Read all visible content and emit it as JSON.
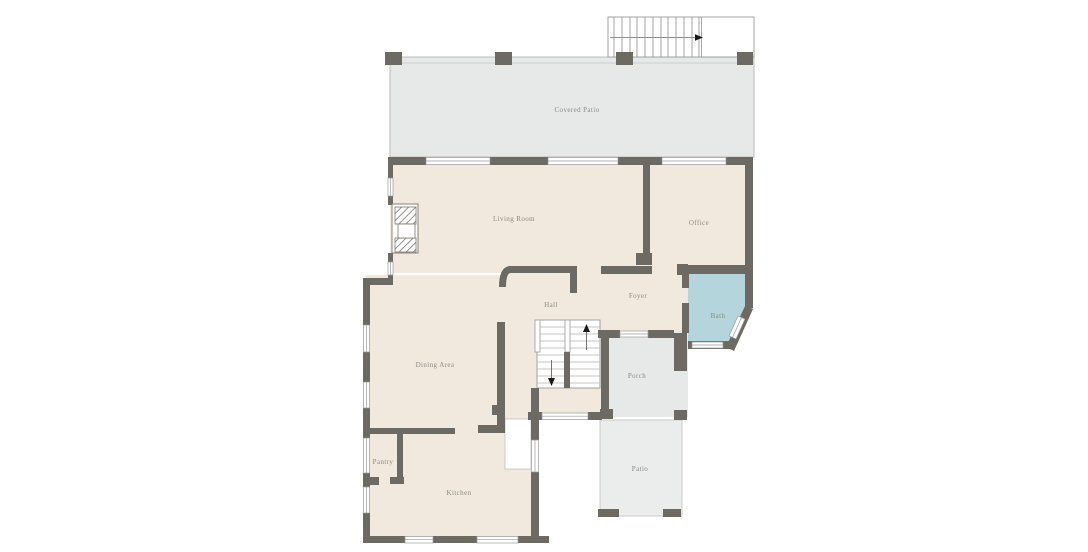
{
  "plan": {
    "type": "floor-plan",
    "floor": "first-floor"
  },
  "rooms": [
    {
      "name": "covered-patio",
      "label": "Covered Patio"
    },
    {
      "name": "living-room",
      "label": "Living Room"
    },
    {
      "name": "office",
      "label": "Office"
    },
    {
      "name": "hall",
      "label": "Hall"
    },
    {
      "name": "foyer",
      "label": "Foyer"
    },
    {
      "name": "bath",
      "label": "Bath"
    },
    {
      "name": "dining-area",
      "label": "Dining Area"
    },
    {
      "name": "porch",
      "label": "Porch"
    },
    {
      "name": "patio",
      "label": "Patio"
    },
    {
      "name": "pantry",
      "label": "Pantry"
    },
    {
      "name": "kitchen",
      "label": "Kitchen"
    }
  ],
  "colors": {
    "background": "#ffffff",
    "wall": "#6d6a64",
    "floor": "#f1e9dd",
    "covered_patio": "#e7e9e9",
    "porch": "#e7e9e9",
    "patio": "#ebecec",
    "bath": "#b4d5db",
    "label_text": "#8d8983",
    "thin_line": "#b3b1ad",
    "window_line": "#9a9a9a",
    "stair_arrow": "#1a1a1a"
  },
  "icons": [
    {
      "name": "stair-up-arrow-icon",
      "meaning": "stairs go up"
    },
    {
      "name": "stair-down-arrow-icon",
      "meaning": "stairs go down"
    },
    {
      "name": "stair-direction-arrow-icon",
      "meaning": "exterior stair direction"
    }
  ]
}
